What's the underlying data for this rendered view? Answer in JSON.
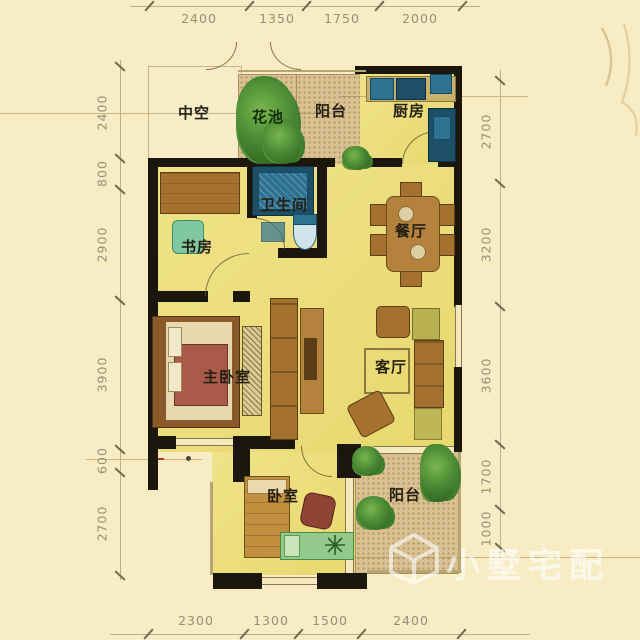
{
  "rooms": {
    "zhongkong": "中空",
    "huachi": "花池",
    "yangtai_top": "阳台",
    "chufang": "厨房",
    "weishengjian": "卫生间",
    "shufang": "书房",
    "canting": "餐厅",
    "zhuwoshi": "主卧室",
    "keting": "客厅",
    "woshi": "卧室",
    "yangtai_bottom": "阳台"
  },
  "dims": {
    "top": [
      "2400",
      "1350",
      "1750",
      "2000"
    ],
    "bottom": [
      "2300",
      "1300",
      "1500",
      "2400"
    ],
    "left": [
      "2400",
      "800",
      "2900",
      "3900",
      "600",
      "2700"
    ],
    "right": [
      "2700",
      "3200",
      "3600",
      "1700",
      "1000"
    ]
  },
  "watermark": {
    "text": "小墅宅配"
  },
  "colors": {
    "background": "#f8ecc4",
    "floor": "#ebdf76",
    "wall": "#1c170d",
    "balcony_texture": "#d9c194",
    "wood_furniture": "#a5712f",
    "bath_fixture_blue": "#2e7291",
    "plant_green": "#3e7c2e",
    "dimension_text": "#8f8973",
    "watermark_white": "rgba(255,255,255,0.62)"
  }
}
